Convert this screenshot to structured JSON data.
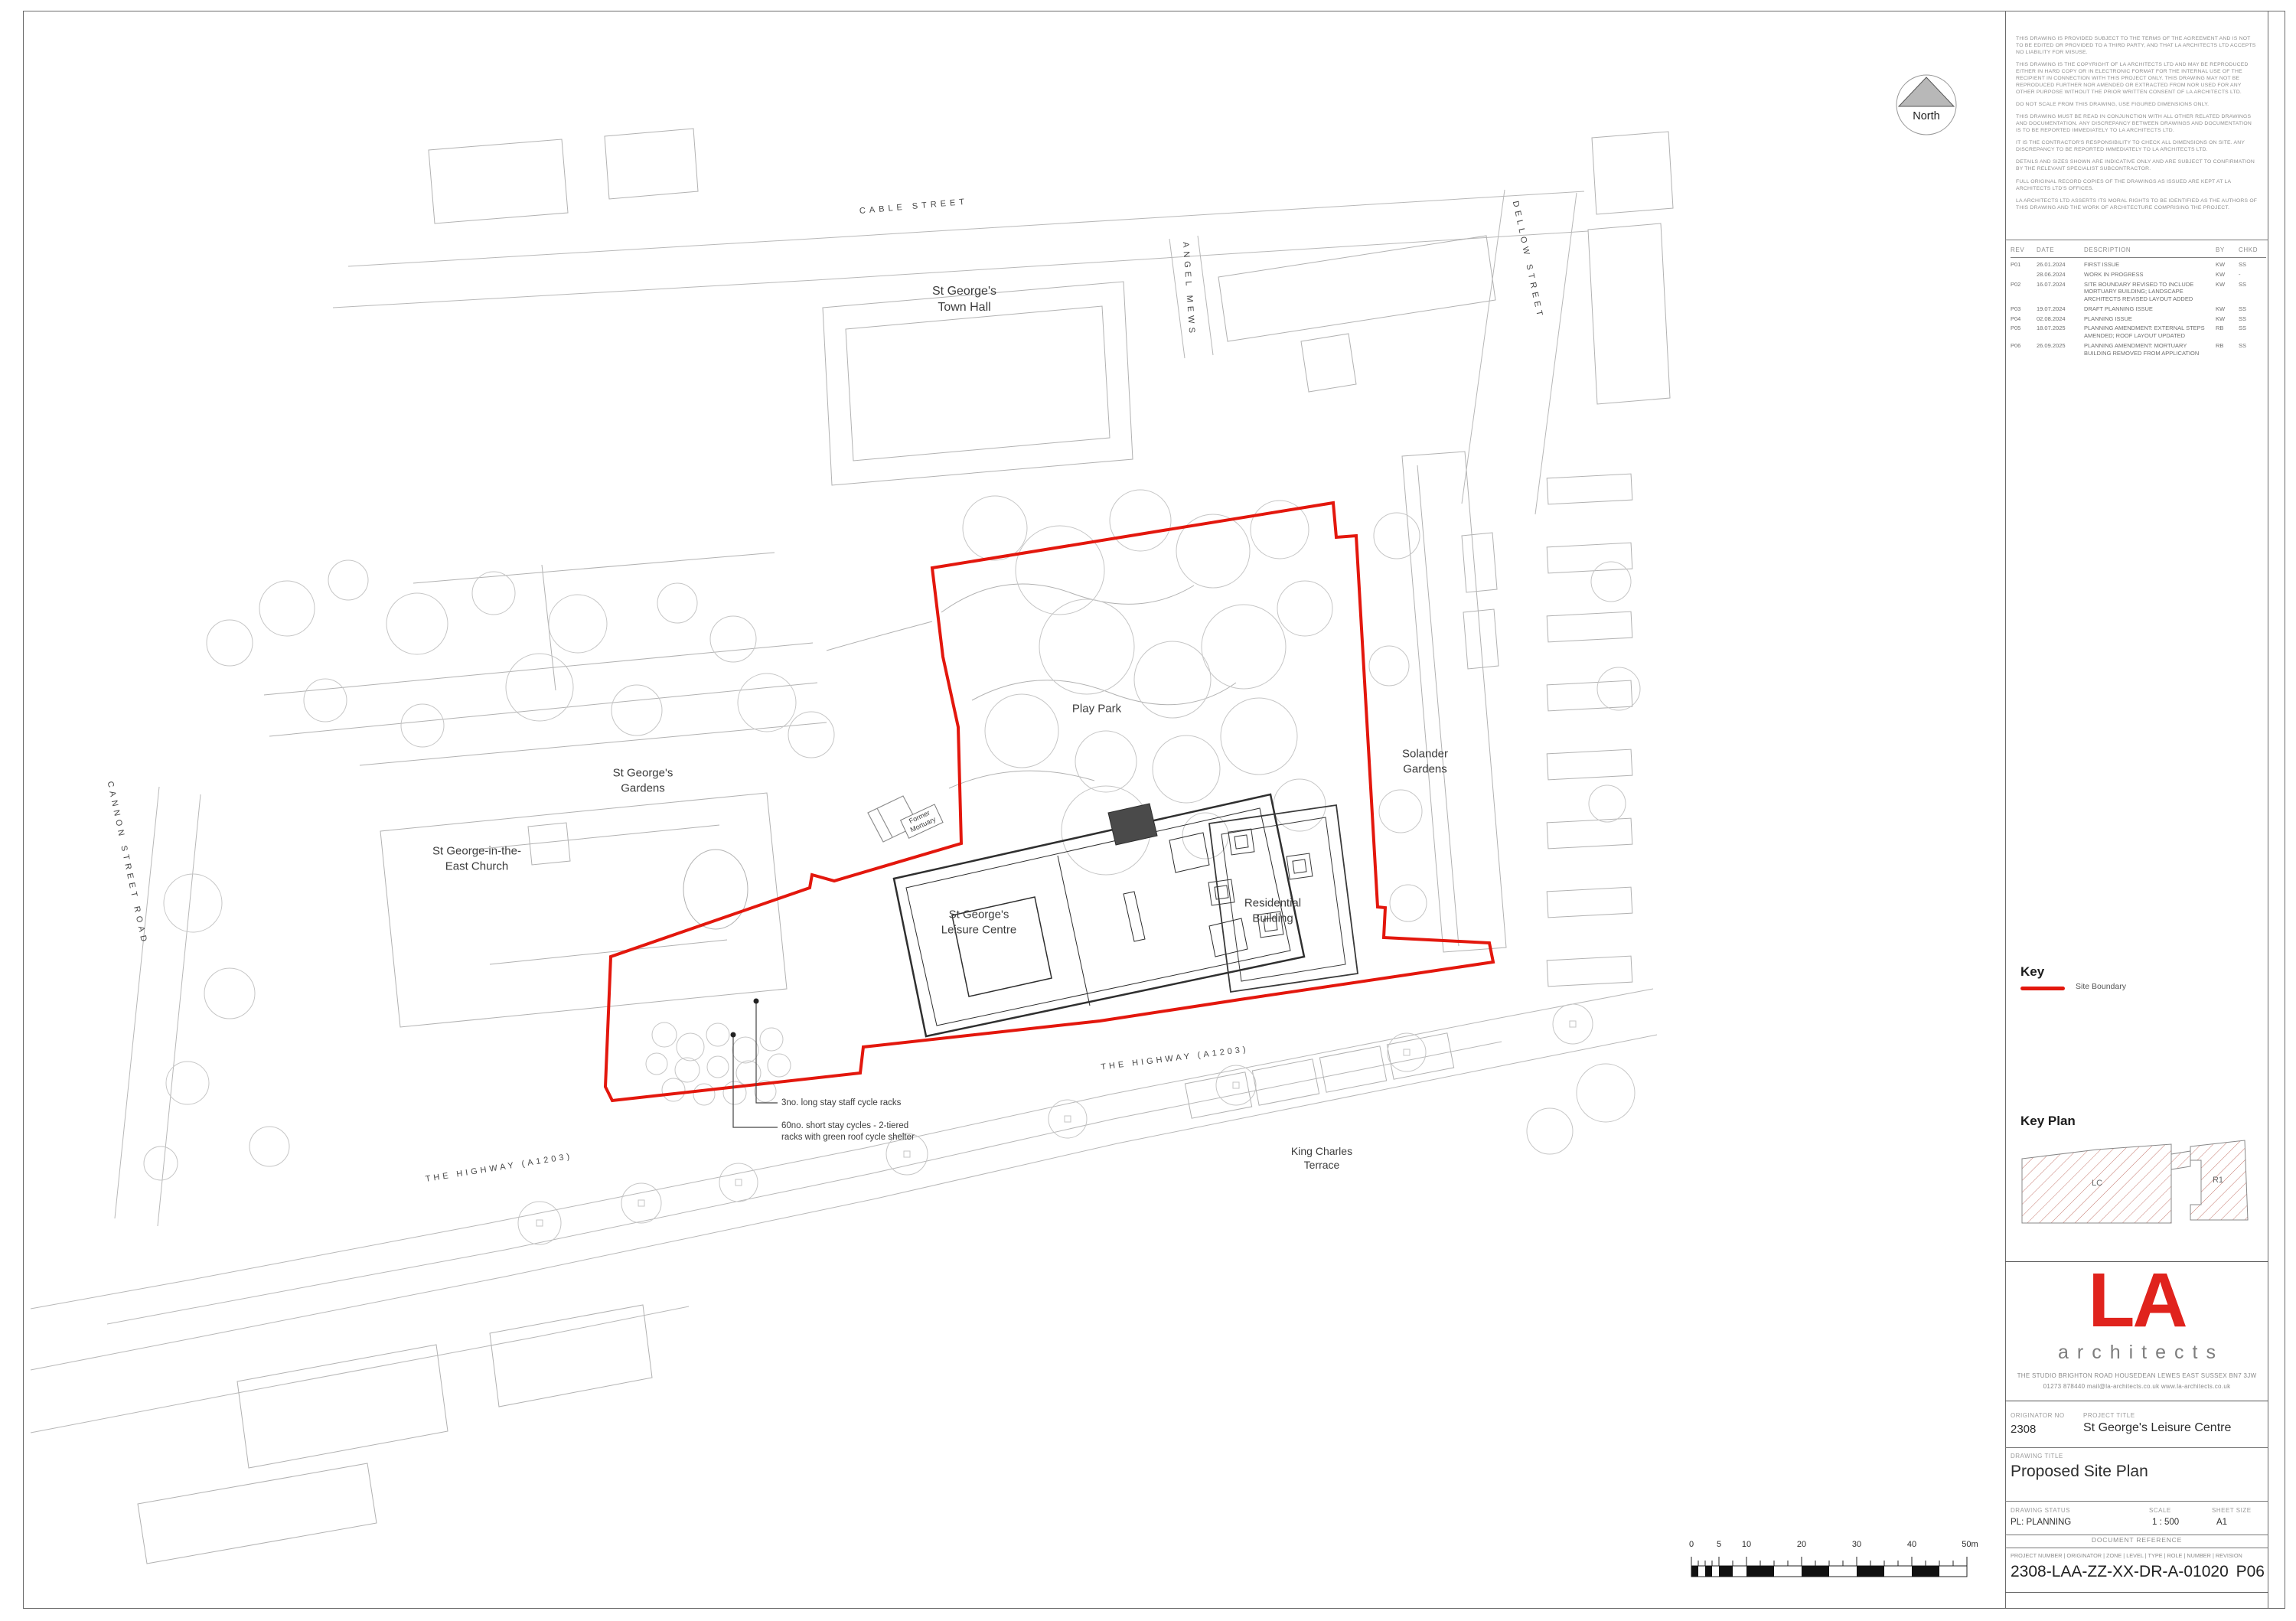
{
  "sheet": {
    "north_label": "North",
    "notes": [
      "THIS DRAWING IS PROVIDED SUBJECT TO THE TERMS OF THE AGREEMENT AND IS NOT TO BE  EDITED OR PROVIDED TO A THIRD PARTY, AND THAT LA ARCHITECTS LTD ACCEPTS NO LIABILITY FOR MISUSE.",
      "THIS DRAWING IS THE COPYRIGHT OF LA ARCHITECTS LTD AND MAY BE REPRODUCED EITHER IN HARD COPY OR IN ELECTRONIC FORMAT FOR THE INTERNAL USE OF THE RECIPIENT IN CONNECTION WITH THIS PROJECT ONLY.  THIS DRAWING MAY NOT BE REPRODUCED FURTHER NOR AMENDED OR EXTRACTED FROM NOR USED FOR ANY OTHER PURPOSE WITHOUT THE PRIOR WRITTEN CONSENT OF LA ARCHITECTS LTD.",
      "DO NOT SCALE FROM THIS DRAWING, USE FIGURED DIMENSIONS ONLY.",
      "THIS DRAWING MUST BE READ IN CONJUNCTION WITH ALL OTHER RELATED DRAWINGS AND DOCUMENTATION.  ANY DISCREPANCY BETWEEN DRAWINGS AND DOCUMENTATION IS TO BE REPORTED IMMEDIATELY TO LA ARCHITECTS LTD.",
      "IT IS THE CONTRACTOR'S RESPONSIBILITY TO CHECK ALL DIMENSIONS ON SITE. ANY DISCREPANCY TO BE REPORTED IMMEDIATELY TO LA ARCHITECTS LTD.",
      "DETAILS AND SIZES SHOWN ARE INDICATIVE ONLY AND ARE SUBJECT TO CONFIRMATION BY THE RELEVANT SPECIALIST SUBCONTRACTOR.",
      "FULL ORIGINAL RECORD COPIES OF THE DRAWINGS AS ISSUED ARE KEPT AT LA ARCHITECTS LTD'S OFFICES.",
      "LA ARCHITECTS LTD ASSERTS ITS MORAL RIGHTS TO BE IDENTIFIED AS THE AUTHORS OF THIS DRAWING AND THE WORK OF ARCHITECTURE COMPRISING THE PROJECT."
    ],
    "revision_table": {
      "headers": [
        "REV",
        "DATE",
        "DESCRIPTION",
        "BY",
        "CHKD"
      ],
      "rows": [
        {
          "rev": "P01",
          "date": "26.01.2024",
          "description": "FIRST ISSUE",
          "by": "KW",
          "chkd": "SS"
        },
        {
          "rev": "",
          "date": "28.06.2024",
          "description": "WORK IN PROGRESS",
          "by": "KW",
          "chkd": "-"
        },
        {
          "rev": "P02",
          "date": "16.07.2024",
          "description": "SITE BOUNDARY REVISED TO INCLUDE MORTUARY BUILDING; LANDSCAPE ARCHITECTS REVISED LAYOUT ADDED",
          "by": "KW",
          "chkd": "SS"
        },
        {
          "rev": "P03",
          "date": "19.07.2024",
          "description": "DRAFT PLANNING ISSUE",
          "by": "KW",
          "chkd": "SS"
        },
        {
          "rev": "P04",
          "date": "02.08.2024",
          "description": "PLANNING ISSUE",
          "by": "KW",
          "chkd": "SS"
        },
        {
          "rev": "P05",
          "date": "18.07.2025",
          "description": "PLANNING AMENDMENT: EXTERNAL STEPS AMENDED; ROOF LAYOUT UPDATED",
          "by": "RB",
          "chkd": "SS"
        },
        {
          "rev": "P06",
          "date": "26.09.2025",
          "description": "PLANNING AMENDMENT: MORTUARY BUILDING REMOVED FROM APPLICATION",
          "by": "RB",
          "chkd": "SS"
        }
      ]
    },
    "key": {
      "title": "Key",
      "site_boundary_label": "Site Boundary",
      "site_boundary_color": "#e3170d"
    },
    "key_plan": {
      "title": "Key Plan",
      "lc_label": "LC",
      "r1_label": "R1"
    },
    "firm": {
      "logo": "LA",
      "logo_sub": "architects",
      "logo_color": "#e0231d",
      "address_line1": "THE STUDIO   BRIGHTON ROAD   HOUSEDEAN   LEWES   EAST SUSSEX   BN7 3JW",
      "address_line2": "01273 878440   mail@la-architects.co.uk   www.la-architects.co.uk"
    },
    "title_block": {
      "originator_label": "ORIGINATOR NO",
      "originator_value": "2308",
      "project_title_label": "PROJECT TITLE",
      "project_title_value": "St George's Leisure Centre",
      "drawing_title_label": "DRAWING TITLE",
      "drawing_title_value": "Proposed Site Plan",
      "status_label": "DRAWING STATUS",
      "status_value": "PL: PLANNING",
      "scale_label": "SCALE",
      "scale_value": "1 : 500",
      "sheet_size_label": "SHEET SIZE",
      "sheet_size_value": "A1",
      "doc_ref_label": "DOCUMENT REFERENCE",
      "doc_ref_fields": "PROJECT NUMBER  | ORIGINATOR | ZONE | LEVEL | TYPE | ROLE | NUMBER |  REVISION",
      "doc_ref_value": "2308-LAA-ZZ-XX-DR-A-01020",
      "doc_ref_revision": "P06"
    },
    "scale_bar": {
      "labels": [
        "0",
        "5",
        "10",
        "20",
        "30",
        "40",
        "50m"
      ]
    }
  },
  "plan": {
    "labels": {
      "cable_street": "CABLE STREET",
      "town_hall": "St George's\nTown Hall",
      "angel_mews": "ANGEL MEWS",
      "dellow_street": "DELLOW STREET",
      "play_park": "Play Park",
      "solander_gardens": "Solander\nGardens",
      "st_georges_gardens": "St George's\nGardens",
      "former_mortuary": "Former\nMortuary",
      "church": "St George-in-the-\nEast Church",
      "leisure_centre": "St George's\nLeisure Centre",
      "residential_building": "Residential\nBuilding",
      "cannon_street_road": "CANNON STREET ROAD",
      "highway_left": "THE HIGHWAY (A1203)",
      "highway_right": "THE HIGHWAY (A1203)",
      "king_charles_terrace": "King Charles\nTerrace",
      "cycle_note_1": "3no. long stay staff cycle racks",
      "cycle_note_2": "60no. short stay cycles - 2-tiered\nracks with green roof cycle shelter"
    }
  }
}
